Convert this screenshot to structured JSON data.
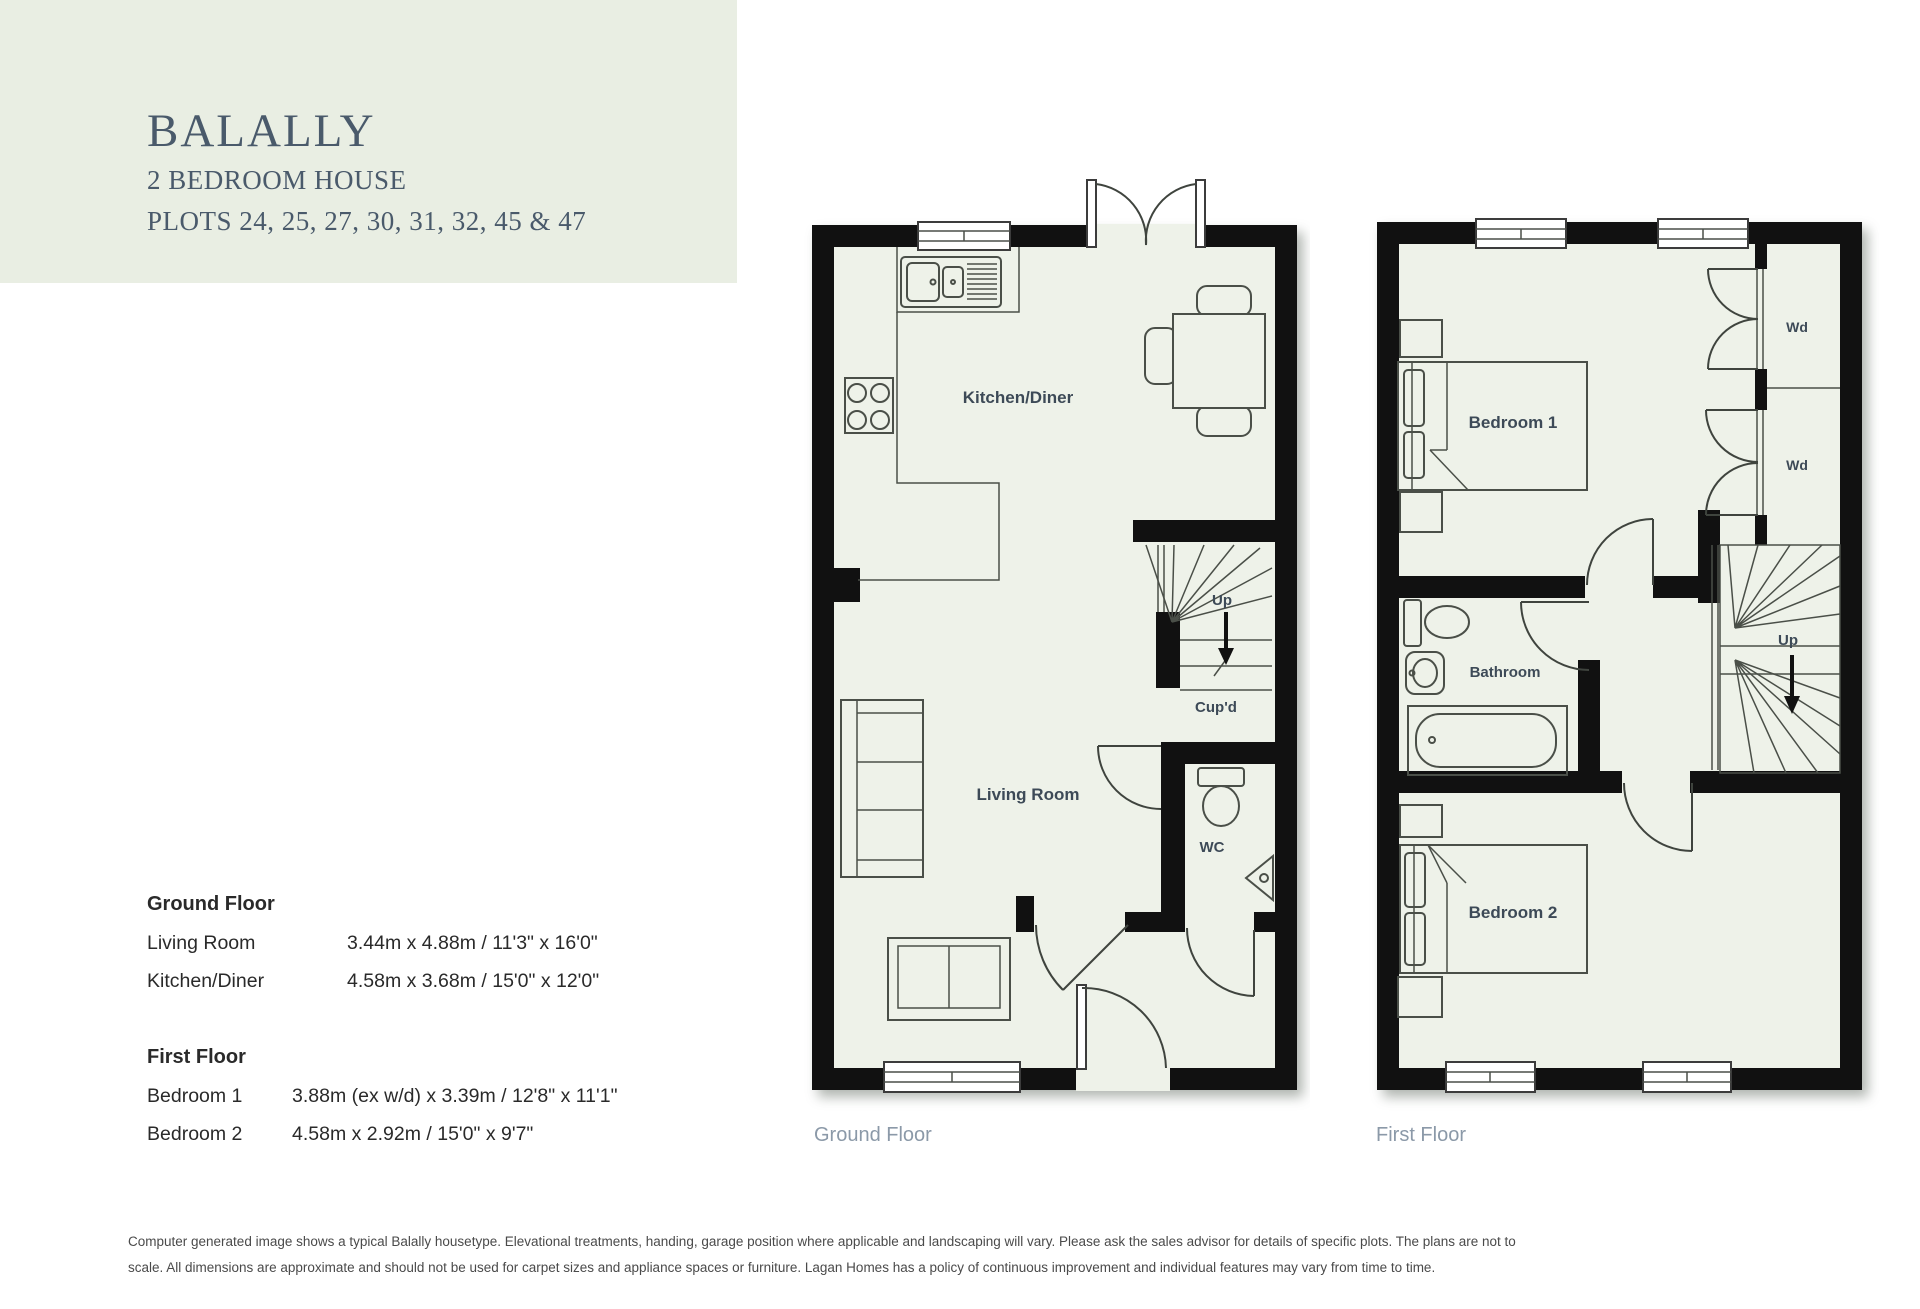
{
  "header": {
    "title": "BALALLY",
    "subtitle": "2 BEDROOM HOUSE",
    "plots": "PLOTS 24, 25, 27, 30, 31, 32, 45 & 47"
  },
  "dimensions": {
    "ground_floor": {
      "heading": "Ground Floor",
      "rows": [
        {
          "room": "Living Room",
          "size": "3.44m x 4.88m / 11'3\" x 16'0\""
        },
        {
          "room": "Kitchen/Diner",
          "size": "4.58m x 3.68m / 15'0\" x 12'0\""
        }
      ]
    },
    "first_floor": {
      "heading": "First Floor",
      "rows": [
        {
          "room": "Bedroom 1",
          "size": "3.88m (ex w/d) x 3.39m / 12'8\" x 11'1\""
        },
        {
          "room": "Bedroom 2",
          "size": "4.58m x 2.92m / 15'0\" x 9'7\""
        }
      ]
    }
  },
  "plans": {
    "ground": {
      "caption": "Ground Floor",
      "labels": {
        "kitchen_diner": "Kitchen/Diner",
        "living_room": "Living Room",
        "up": "Up",
        "cupboard": "Cup'd",
        "wc": "WC"
      }
    },
    "first": {
      "caption": "First Floor",
      "labels": {
        "bedroom1": "Bedroom 1",
        "bedroom2": "Bedroom 2",
        "bathroom": "Bathroom",
        "up": "Up",
        "wardrobe_top": "Wd",
        "wardrobe_bottom": "Wd"
      }
    }
  },
  "disclaimer": {
    "line1": "Computer generated image shows a typical Balally housetype. Elevational treatments, handing, garage position where applicable and landscaping will vary. Please ask the sales advisor for details of specific plots. The plans are not to",
    "line2": "scale. All dimensions are approximate and should not be used for carpet sizes and appliance spaces or furniture. Lagan Homes has a policy of continuous improvement and individual features may vary from time to time."
  },
  "colors": {
    "header_bg": "#e9eee3",
    "floor_fill": "#eef2e9",
    "wall": "#111111",
    "plan_label": "#3d4a57",
    "caption": "#8b99a8",
    "title_text": "#4a5a6b"
  }
}
